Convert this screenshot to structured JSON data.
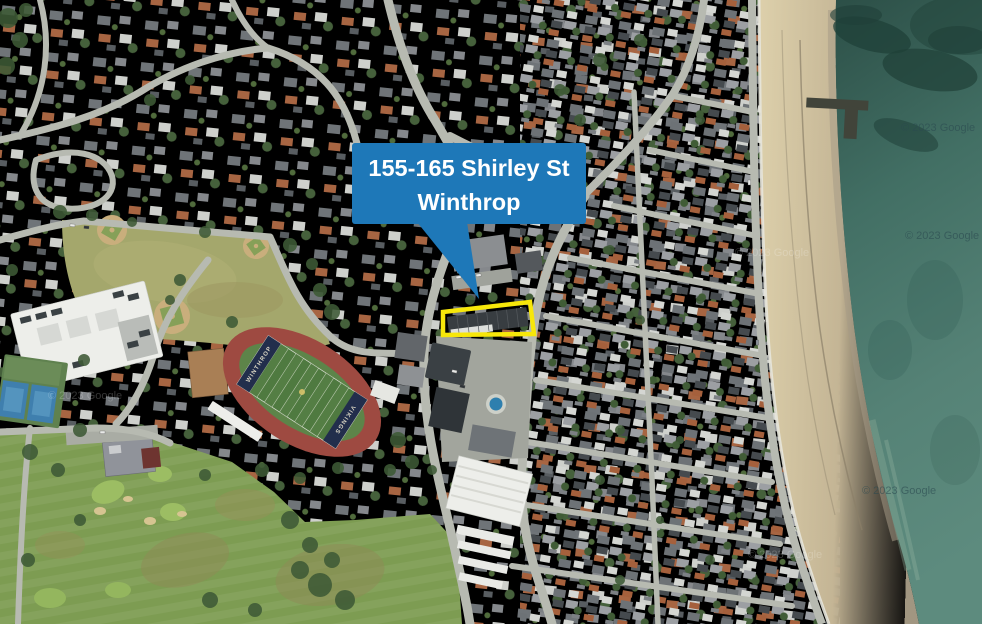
{
  "annotation": {
    "callout": {
      "line1": "155-165 Shirley St",
      "line2": "Winthrop"
    }
  },
  "stadium": {
    "endzone_left": "WINTHROP",
    "endzone_right": "VIKINGS"
  },
  "watermarks": [
    {
      "text": "© 2023 Google"
    },
    {
      "text": "© 2023 Google"
    },
    {
      "text": "© 2023 Google"
    },
    {
      "text": "© 2023 Google"
    },
    {
      "text": "© 2023 Google"
    },
    {
      "text": "© 2023 Google"
    }
  ],
  "colors": {
    "callout-blue": "#1e78b8",
    "parcel-yellow": "#f7e70a",
    "land-base": "#9094855",
    "road-gray": "#b7bab1",
    "park-grass": "#a4a76c",
    "track-red": "#9e4a41",
    "field-green": "#4f7a40",
    "endzone-navy": "#222e4c",
    "golf-green": "#7d9c52",
    "ocean-deep": "#2c4f47",
    "ocean-light": "#5d8b7e",
    "sand": "#d8cba6",
    "tree-green": "#3e5a36",
    "building-white": "#edeeea",
    "roof-dark": "#3a4044",
    "watermark-dark": "#2b4a50"
  }
}
